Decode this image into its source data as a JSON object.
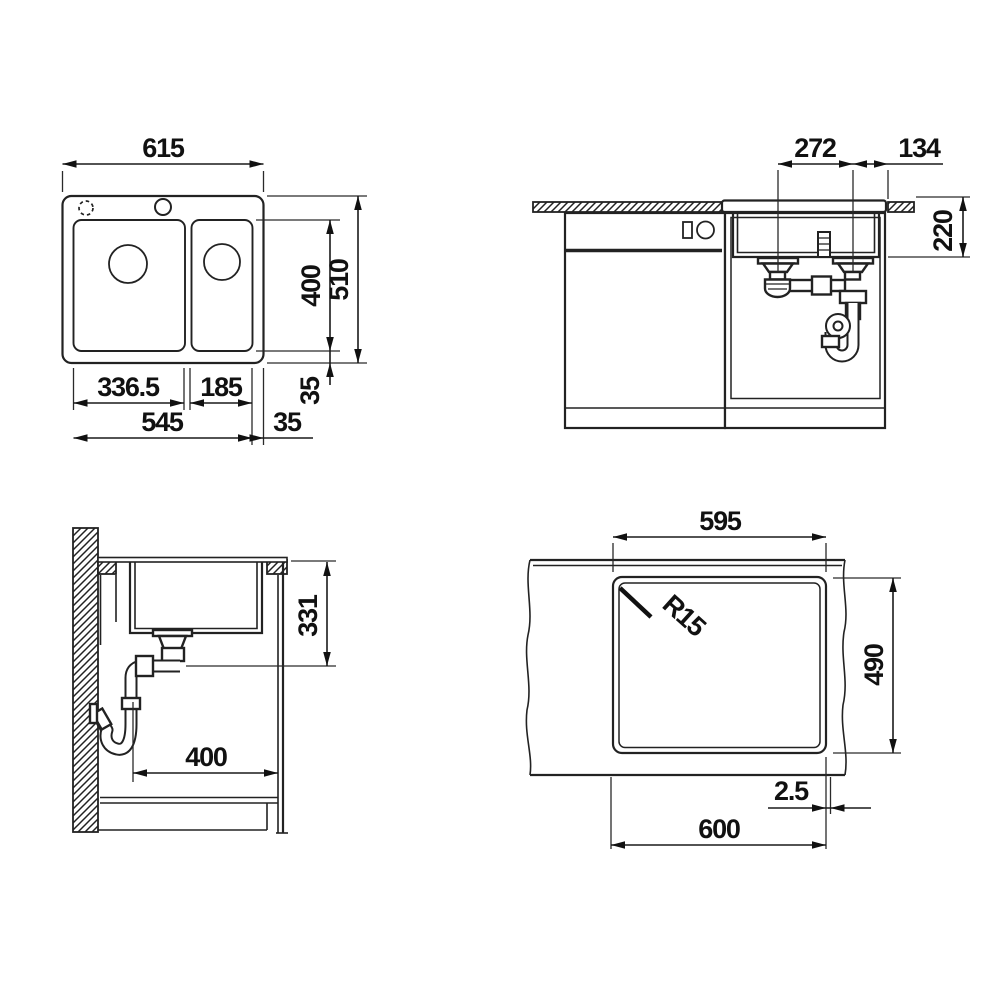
{
  "colors": {
    "line": "#222222",
    "text": "#111111",
    "background": "#ffffff"
  },
  "views": {
    "top_view": {
      "label": "sink plan view",
      "dims": {
        "overall_width": "615",
        "bowl_left_width": "336.5",
        "bowl_right_width": "185",
        "bowls_total_width": "545",
        "right_margin": "35",
        "bowl_depth": "400",
        "overall_depth": "510",
        "bottom_margin": "35"
      }
    },
    "front_view": {
      "label": "cabinet front section",
      "dims": {
        "drain_spacing": "272",
        "drain_to_edge": "134",
        "under_top_depth": "220"
      }
    },
    "side_view": {
      "label": "cabinet side section",
      "dims": {
        "depth_below_top": "331",
        "cabinet_depth": "400"
      }
    },
    "cutout_view": {
      "label": "worktop cut-out",
      "dims": {
        "cutout_width": "595",
        "corner_radius": "R15",
        "cutout_depth": "490",
        "edge_offset": "2.5",
        "overall_width": "600"
      }
    }
  }
}
